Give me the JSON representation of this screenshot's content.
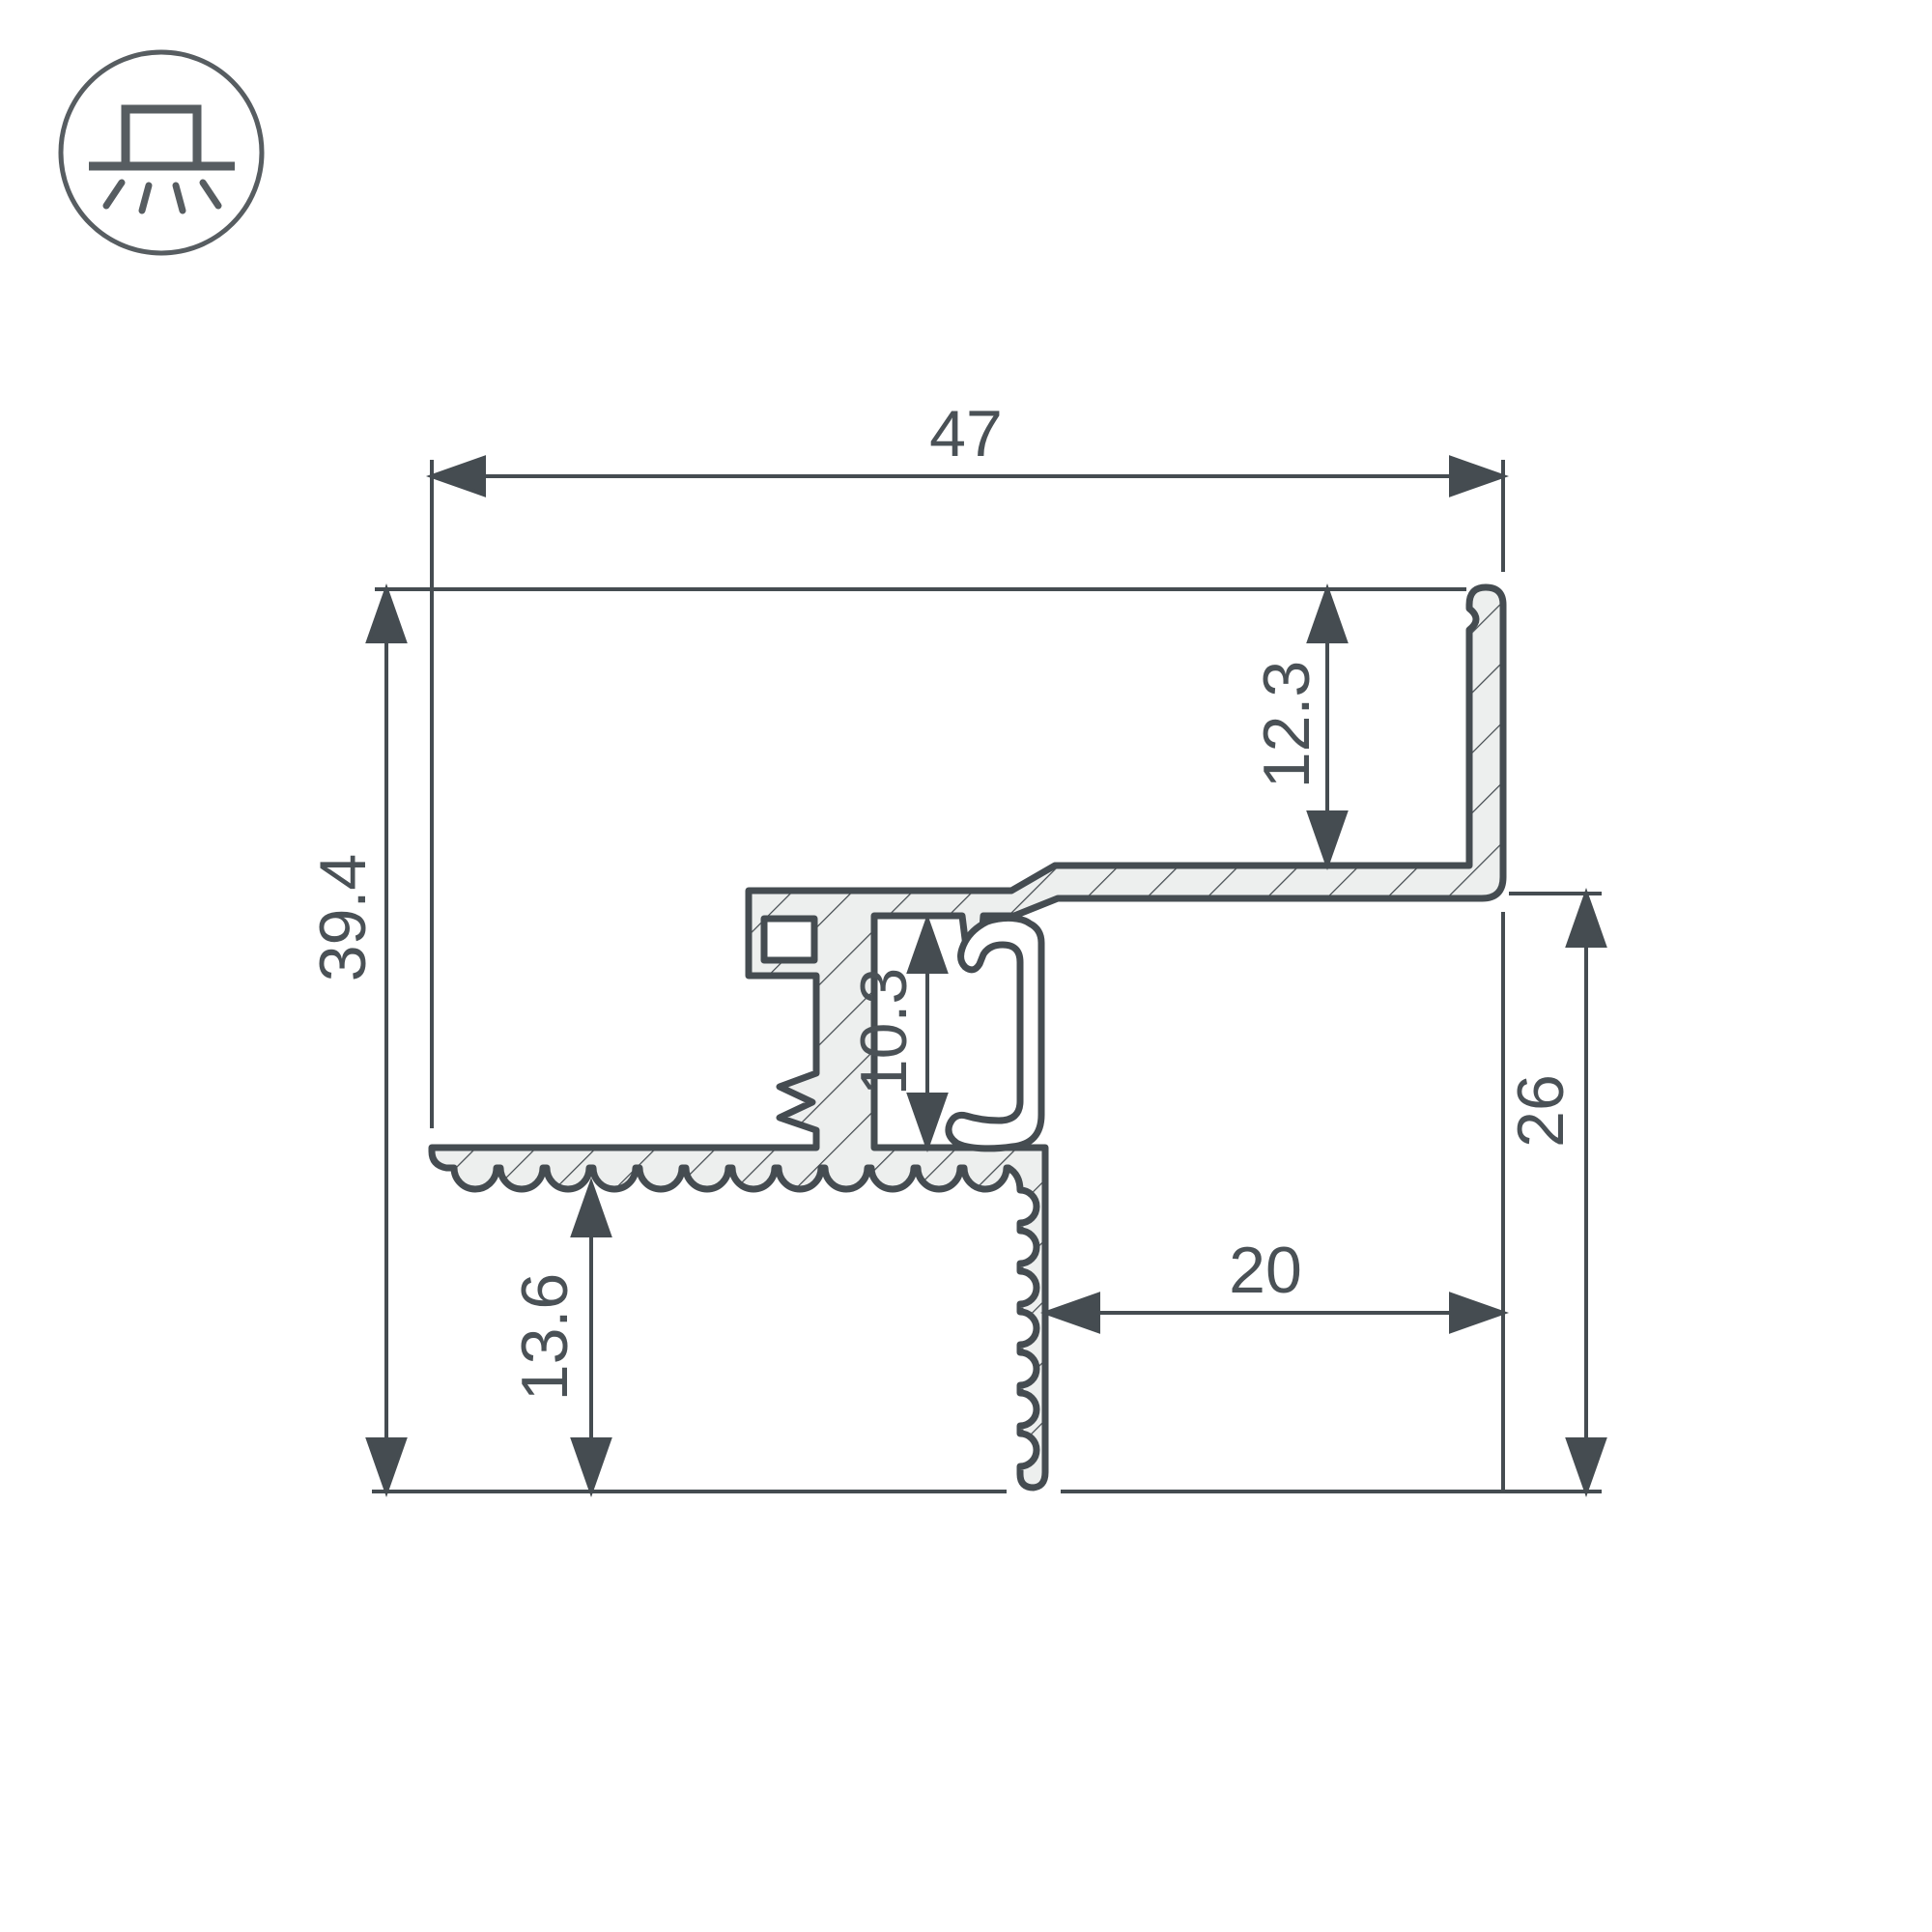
{
  "drawing": {
    "type": "technical-cross-section",
    "icon": {
      "name": "recessed-light-icon"
    },
    "dimensions": {
      "total_width": "47",
      "total_height": "39.4",
      "flange_height": "12.3",
      "channel_height": "10.3",
      "right_drop_height": "26",
      "bottom_offset_height": "13.6",
      "horizontal_offset": "20"
    },
    "colors": {
      "line": "#454C51",
      "text": "#4A5156",
      "metal_fill": "#EDEFEE",
      "background": "#FFFFFF"
    }
  }
}
